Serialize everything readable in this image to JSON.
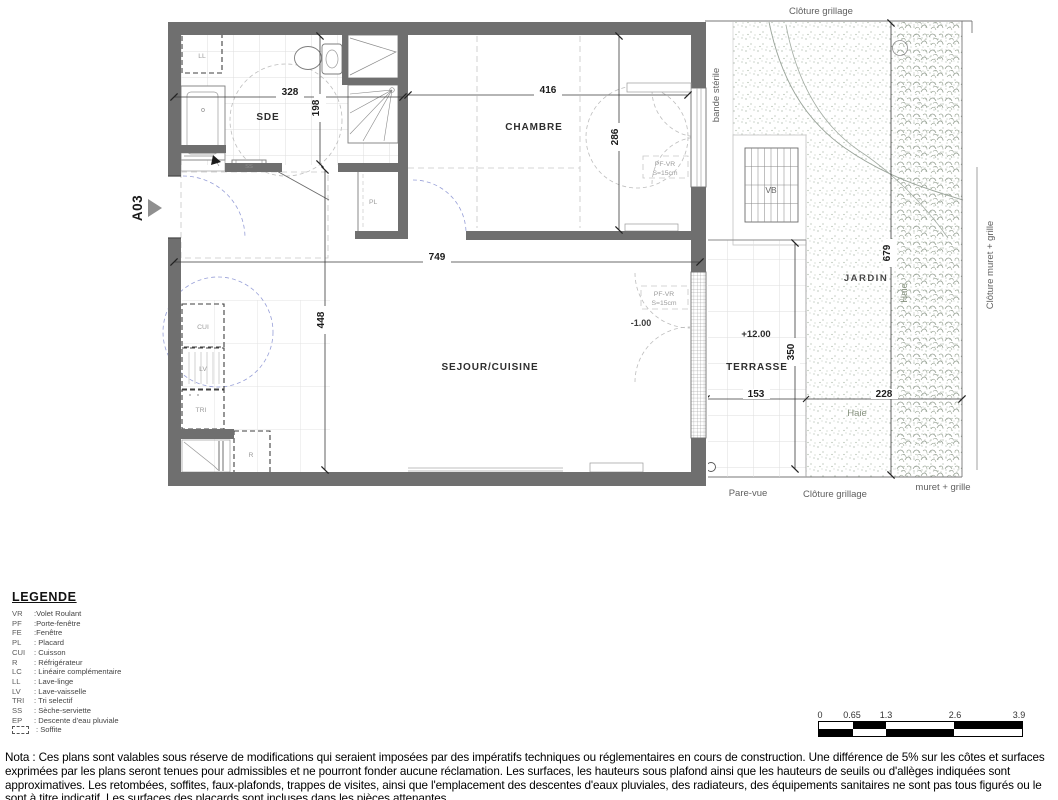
{
  "plan": {
    "unit": "A03",
    "rooms": {
      "sde": "SDE",
      "chambre": "CHAMBRE",
      "sejour": "SEJOUR/CUISINE",
      "terrasse": "TERRASSE",
      "jardin": "JARDIN"
    },
    "levels": {
      "terrasse": "+12.00",
      "sejour": "-1.00"
    },
    "dims": {
      "sde_w": "328",
      "sde_h": "198",
      "ch_w": "416",
      "ch_h": "286",
      "sej_w": "749",
      "sej_h": "448",
      "jard_h": "679",
      "terr_h": "350",
      "terr_w": "153",
      "haie_w": "228"
    },
    "equipment": {
      "ll": "LL",
      "ss": "SS",
      "pl": "PL",
      "cui": "CUI",
      "lv": "LV",
      "tri": "TRI",
      "r": "R",
      "vb": "VB",
      "pf_vr": "PF-VR",
      "pf_vr_s": "S=15cm"
    },
    "site": {
      "cloture_grillage_top": "Clôture grillage",
      "bande_sterile": "bande stérile",
      "cloture_muret": "Clôture muret + grille",
      "haie_v": "Haie",
      "haie_h": "Haie",
      "pare_vue": "Pare-vue",
      "cloture_grillage_bottom": "Clôture grillage",
      "muret_grille": "muret + grille"
    }
  },
  "legend": {
    "title": "LEGENDE",
    "items": [
      {
        "abbr": "VR",
        "label": ":Volet Roulant"
      },
      {
        "abbr": "PF",
        "label": ":Porte-fenêtre"
      },
      {
        "abbr": "FE",
        "label": ":Fenêtre"
      },
      {
        "abbr": "PL",
        "label": ": Placard"
      },
      {
        "abbr": "CUI",
        "label": ": Cuisson"
      },
      {
        "abbr": "R",
        "label": ": Réfrigérateur"
      },
      {
        "abbr": "LC",
        "label": ": Linéaire complémentaire"
      },
      {
        "abbr": "LL",
        "label": ": Lave-linge"
      },
      {
        "abbr": "LV",
        "label": ": Lave-vaisselle"
      },
      {
        "abbr": "TRI",
        "label": ": Tri selectif"
      },
      {
        "abbr": "SS",
        "label": ": Sèche-serviette"
      },
      {
        "abbr": "EP",
        "label": ": Descente d'eau pluviale"
      },
      {
        "abbr": "",
        "label": ": Soffite",
        "icon": "dashed-box"
      }
    ]
  },
  "scalebar": {
    "labels": [
      "0",
      "0.65",
      "1.3",
      "2.6",
      "3.9"
    ]
  },
  "nota": "Nota : Ces plans sont valables sous réserve de modifications qui seraient imposées par des impératifs techniques ou réglementaires en cours de construction. Une différence de 5% sur les côtes et surfaces exprimées par les plans seront tenues pour admissibles et ne pourront fonder aucune réclamation. Les surfaces, les hauteurs sous plafond ainsi que les hauteurs de seuils ou d'allèges indiquées sont approximatives. Les retombées, soffites, faux-plafonds, trappes de visites, ainsi que l'emplacement des descentes d'eaux pluviales, des radiateurs, des équipements sanitaires ne sont pas tous figurés ou le sont à titre indicatif. Les surfaces des placards sont incluses dans les pièces attenantes."
}
